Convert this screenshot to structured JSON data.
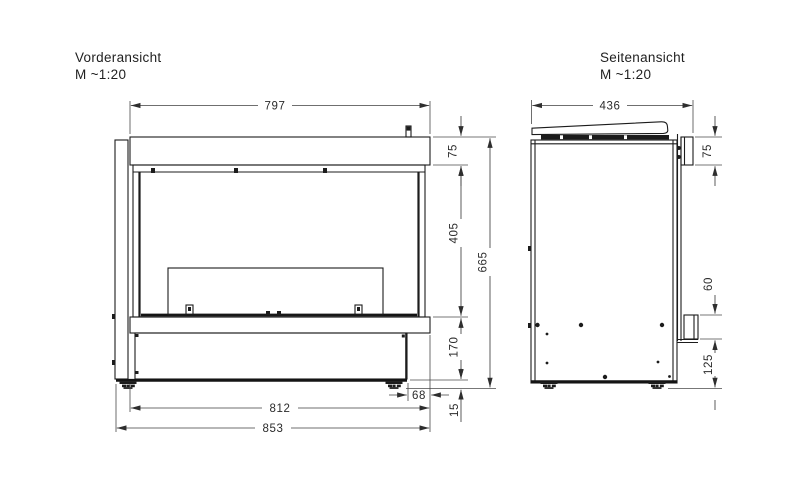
{
  "drawing": {
    "front": {
      "title": "Vorderansicht",
      "scale": "M  ~1:20",
      "dims": {
        "top_width": "797",
        "hood_height": "75",
        "glass_height": "405",
        "total_height": "665",
        "plinth_height": "170",
        "base_inset": "68",
        "body_width": "812",
        "feet_height": "15",
        "overall_width": "853"
      }
    },
    "side": {
      "title": "Seitenansicht",
      "scale": "M  ~1:20",
      "dims": {
        "depth": "436",
        "frame_height": "75",
        "bracket_height": "60",
        "plinth_height": "125"
      }
    },
    "colors": {
      "ink": "#1c1c1c",
      "dim_ink": "#3f3f3f",
      "background": "#ffffff"
    }
  }
}
